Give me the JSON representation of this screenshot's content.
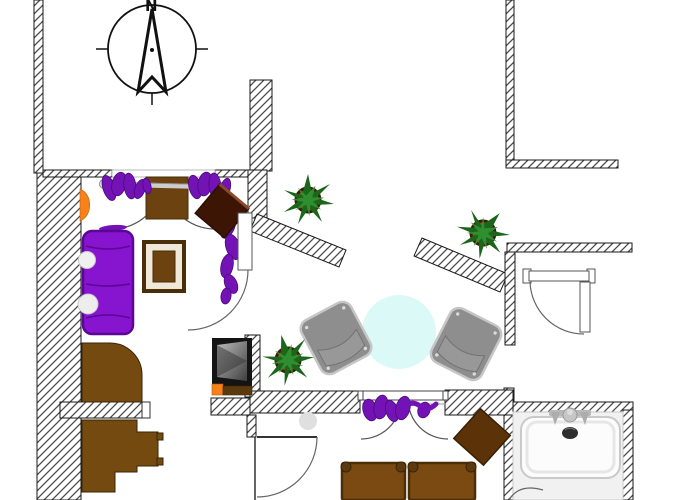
{
  "document": {
    "kind": "apartment-floor-plan",
    "visible_text": [
      "N"
    ]
  },
  "compass": {
    "label": "N"
  },
  "palette": {
    "background": "#ffffff",
    "wall_hatch_line": "#4a4a4a",
    "wall_border": "#1a1a1a",
    "sofa_purple": "#8714CF",
    "clothes_purple": "#7312B5",
    "wood_brown": "#744A10",
    "wood_dark": "#4A2E08",
    "dark_table_brown": "#3D1505",
    "armchair_gray": "#8E8E8E",
    "round_table_cyan": "#DBF9F7",
    "plant_leaf_green": "#1E701E",
    "plant_pot_brown": "#A0522D",
    "accent_orange": "#F8821A",
    "tub_white": "#FCFCFC"
  },
  "symbols": {
    "fixtures": [
      "compass-rose",
      "walls-hatched",
      "door-swings",
      "coat-rod-with-clothes",
      "entry-mat",
      "wall-lamp",
      "wardrobe-with-clothes"
    ],
    "furniture": [
      "sofa",
      "coffee-table",
      "side-cabinet-diamond",
      "fireplace-stove",
      "corner-desk",
      "stair-steps",
      "armchair-left",
      "armchair-right",
      "round-side-table",
      "square-table-diamond",
      "dining-seats",
      "bathtub"
    ],
    "plants": [
      "potted-plant-hall",
      "potted-plant-right",
      "potted-plant-living"
    ]
  }
}
